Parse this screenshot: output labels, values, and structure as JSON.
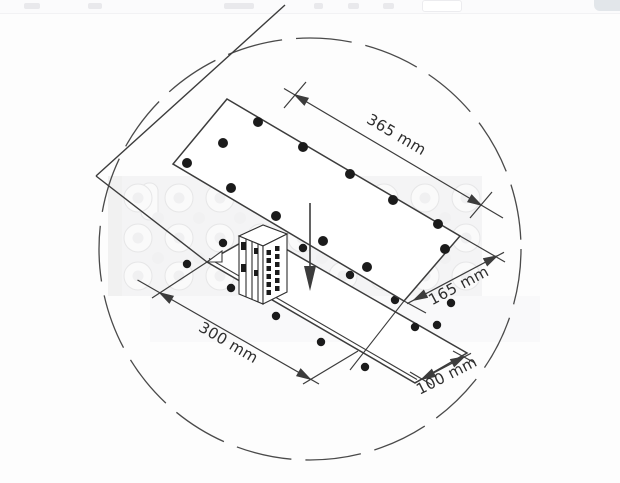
{
  "window": {
    "top_strip_visible": true
  },
  "diagram": {
    "type": "isometric-drilling-dimension-diagram",
    "boundary": "dashed-circle",
    "insert_arrow_direction": "down",
    "dimensions": [
      {
        "id": "top-plate-length",
        "label": "365 mm"
      },
      {
        "id": "top-plate-width",
        "label": "165 mm"
      },
      {
        "id": "bottom-plate-length",
        "label": "300 mm"
      },
      {
        "id": "bottom-plate-width",
        "label": "100 mm"
      }
    ],
    "colors": {
      "line": "#3c3c3c",
      "hole": "#1b1b1b",
      "text": "#2e2e2e",
      "background": "#fdfdfd",
      "faint_photo": "#f3f3f4"
    }
  }
}
